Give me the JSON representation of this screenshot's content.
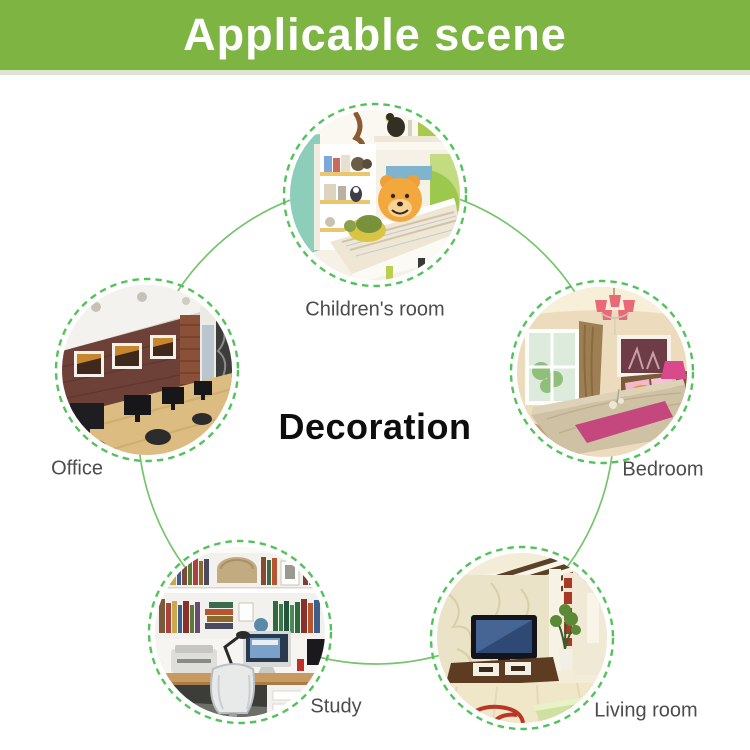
{
  "header": {
    "title": "Applicable scene"
  },
  "center": {
    "label": "Decoration"
  },
  "colors": {
    "banner_green": "#7eb442",
    "big_circle_green": "#76c56c",
    "dashed_ring_green": "#53c25b",
    "label_gray": "#4c4c4c"
  },
  "diagram": {
    "scenes": [
      {
        "name": "childrens-room",
        "label": "Children's room"
      },
      {
        "name": "bedroom",
        "label": "Bedroom"
      },
      {
        "name": "living-room",
        "label": "Living room"
      },
      {
        "name": "study",
        "label": "Study"
      },
      {
        "name": "office",
        "label": "Office"
      }
    ]
  }
}
